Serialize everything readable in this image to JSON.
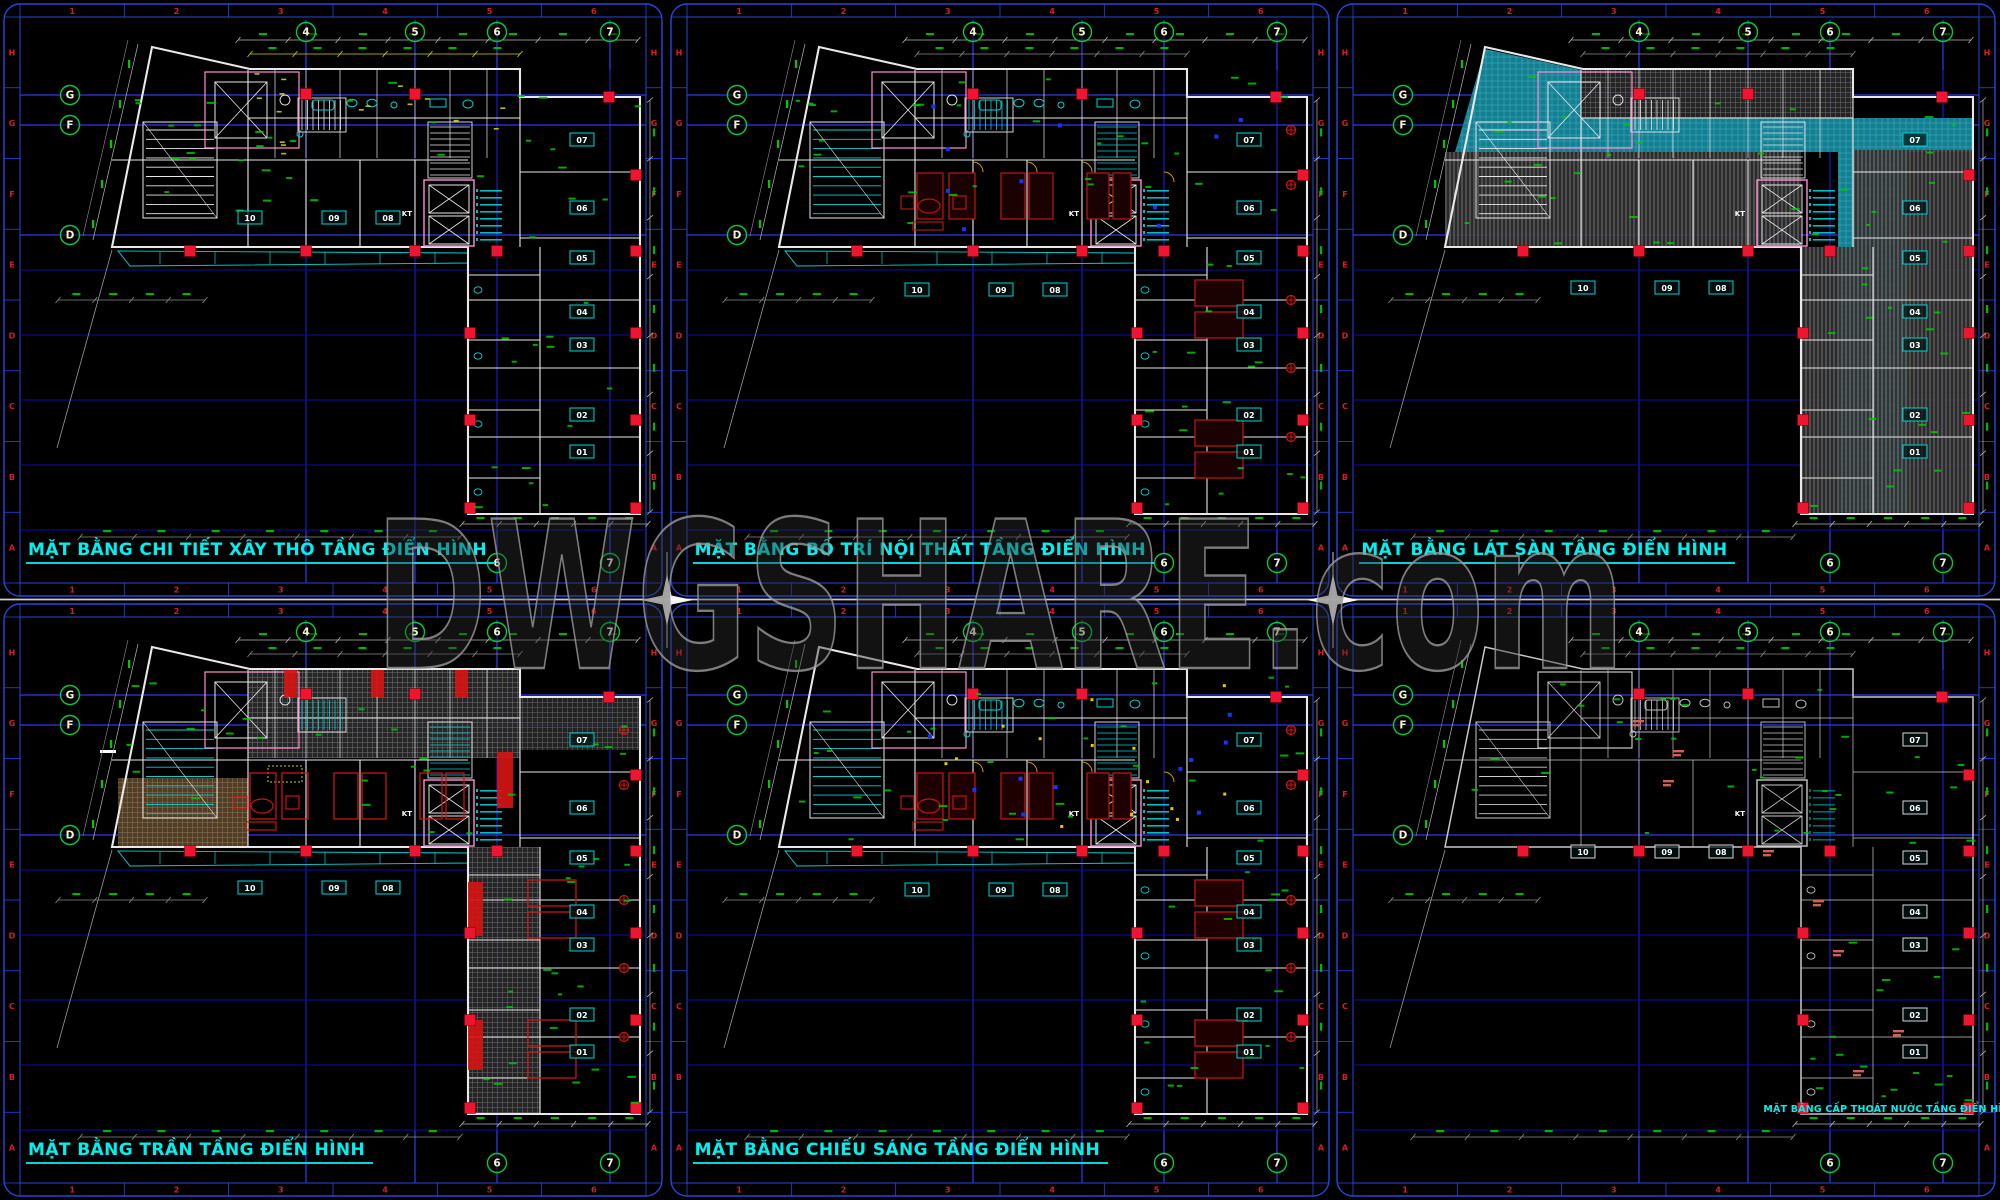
{
  "watermark": {
    "text": "DWGSHARE.com"
  },
  "sheet": {
    "zone_numbers": [
      "1",
      "2",
      "3",
      "4",
      "5",
      "6"
    ],
    "zone_letters": [
      "H",
      "G",
      "F",
      "E",
      "D",
      "C",
      "B",
      "A"
    ]
  },
  "grid": {
    "top_bubbles": [
      "4",
      "5",
      "6",
      "7"
    ],
    "left_bubbles": [
      "G",
      "F",
      "D"
    ],
    "bottom_bubbles": [
      "6",
      "7"
    ]
  },
  "rooms": {
    "bar_labels": [
      "10",
      "09",
      "08"
    ],
    "wing_labels": [
      "07",
      "06",
      "05",
      "04",
      "03",
      "02",
      "01"
    ],
    "shaft_label": "KT"
  },
  "panels": [
    {
      "id": "xay-tho",
      "title": "MẶT BẰNG CHI TIẾT XÂY THÔ TẦNG ĐIỂN HÌNH",
      "theme": "construction"
    },
    {
      "id": "noi-that",
      "title": "MẶT BẰNG BỐ TRÍ NỘI THẤT TẦNG ĐIỂN HÌNH",
      "theme": "interior"
    },
    {
      "id": "lat-san",
      "title": "MẶT BẰNG LÁT SÀN TẦNG ĐIỂN HÌNH",
      "theme": "flooring"
    },
    {
      "id": "tran",
      "title": "MẶT BẰNG TRẦN TẦNG ĐIỂN HÌNH",
      "theme": "ceiling"
    },
    {
      "id": "chieu-sang",
      "title": "MẶT BẰNG CHIẾU SÁNG TẦNG ĐIỂN HÌNH",
      "theme": "lighting"
    },
    {
      "id": "cap-thoat-nuoc",
      "title": "MẶT BẰNG CẤP THOÁT NƯỚC TẦNG ĐIỂN HÌNH",
      "theme": "plumbing"
    }
  ],
  "colors": {
    "background": "#000000",
    "border_blue": "#2746e0",
    "grid_blue": "#1d1dd2",
    "grid_blue_dim": "#0d0da8",
    "grid_blue_bright": "#2d3bee",
    "bubble_green": "#00cc3c",
    "bubble_text": "#f4f4c0",
    "zone_red": "#d42020",
    "title_cyan": "#00f0f0",
    "column_red": "#ef1430",
    "wall_white": "#e8e8e8",
    "fixture_cyan": "#00d2d2",
    "dim_green": "#00c800",
    "dim_yellow": "#d2d200",
    "teal_floor": "#157f92",
    "furniture_red": "#b41616",
    "magenta_pink": "#ff8fd2",
    "orange_tan": "#b4701e",
    "watermark_gray": "#989898",
    "separator_white": "#f2f2f2"
  }
}
